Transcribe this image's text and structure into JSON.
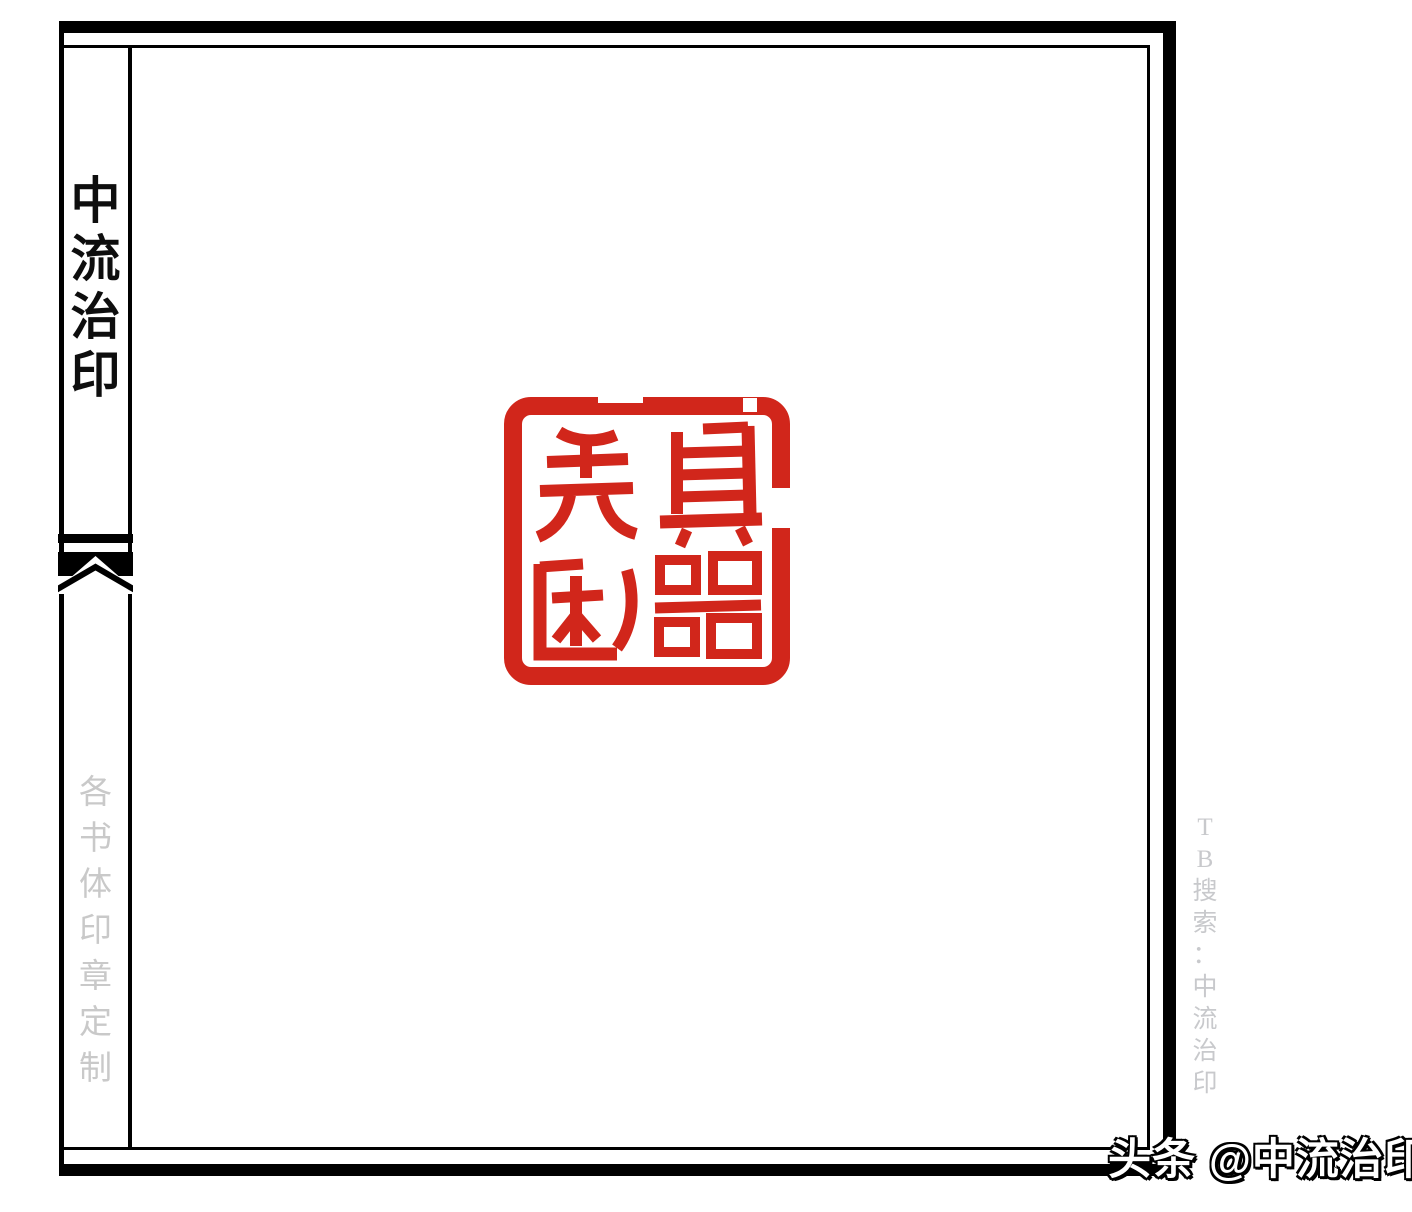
{
  "page": {
    "background": "#ffffff",
    "frame_color": "#000000"
  },
  "sidebar": {
    "title": "中流治印",
    "title_chars": [
      "中",
      "流",
      "治",
      "印"
    ],
    "footer_text": "各书体印章定制",
    "footer_chars": [
      "各",
      "书",
      "体",
      "印",
      "章",
      "定",
      "制"
    ],
    "text_color": "#c9c9c9"
  },
  "seal": {
    "phrase": "先利其器",
    "characters": {
      "top_right": "其",
      "bottom_right": "器",
      "top_left": "先",
      "bottom_left": "利"
    },
    "color": "#d1261b",
    "style": "red square seal impression, 2x2 seal-script characters"
  },
  "right_margin": {
    "text": "TB搜索：中流治印",
    "chars": [
      "T",
      "B",
      "搜",
      "索",
      "：",
      "中",
      "流",
      "治",
      "印"
    ],
    "color": "#c8c9cc"
  },
  "watermark": {
    "text": "头条 @中流治印",
    "fill": "#ffffff",
    "outline": "#000000"
  }
}
